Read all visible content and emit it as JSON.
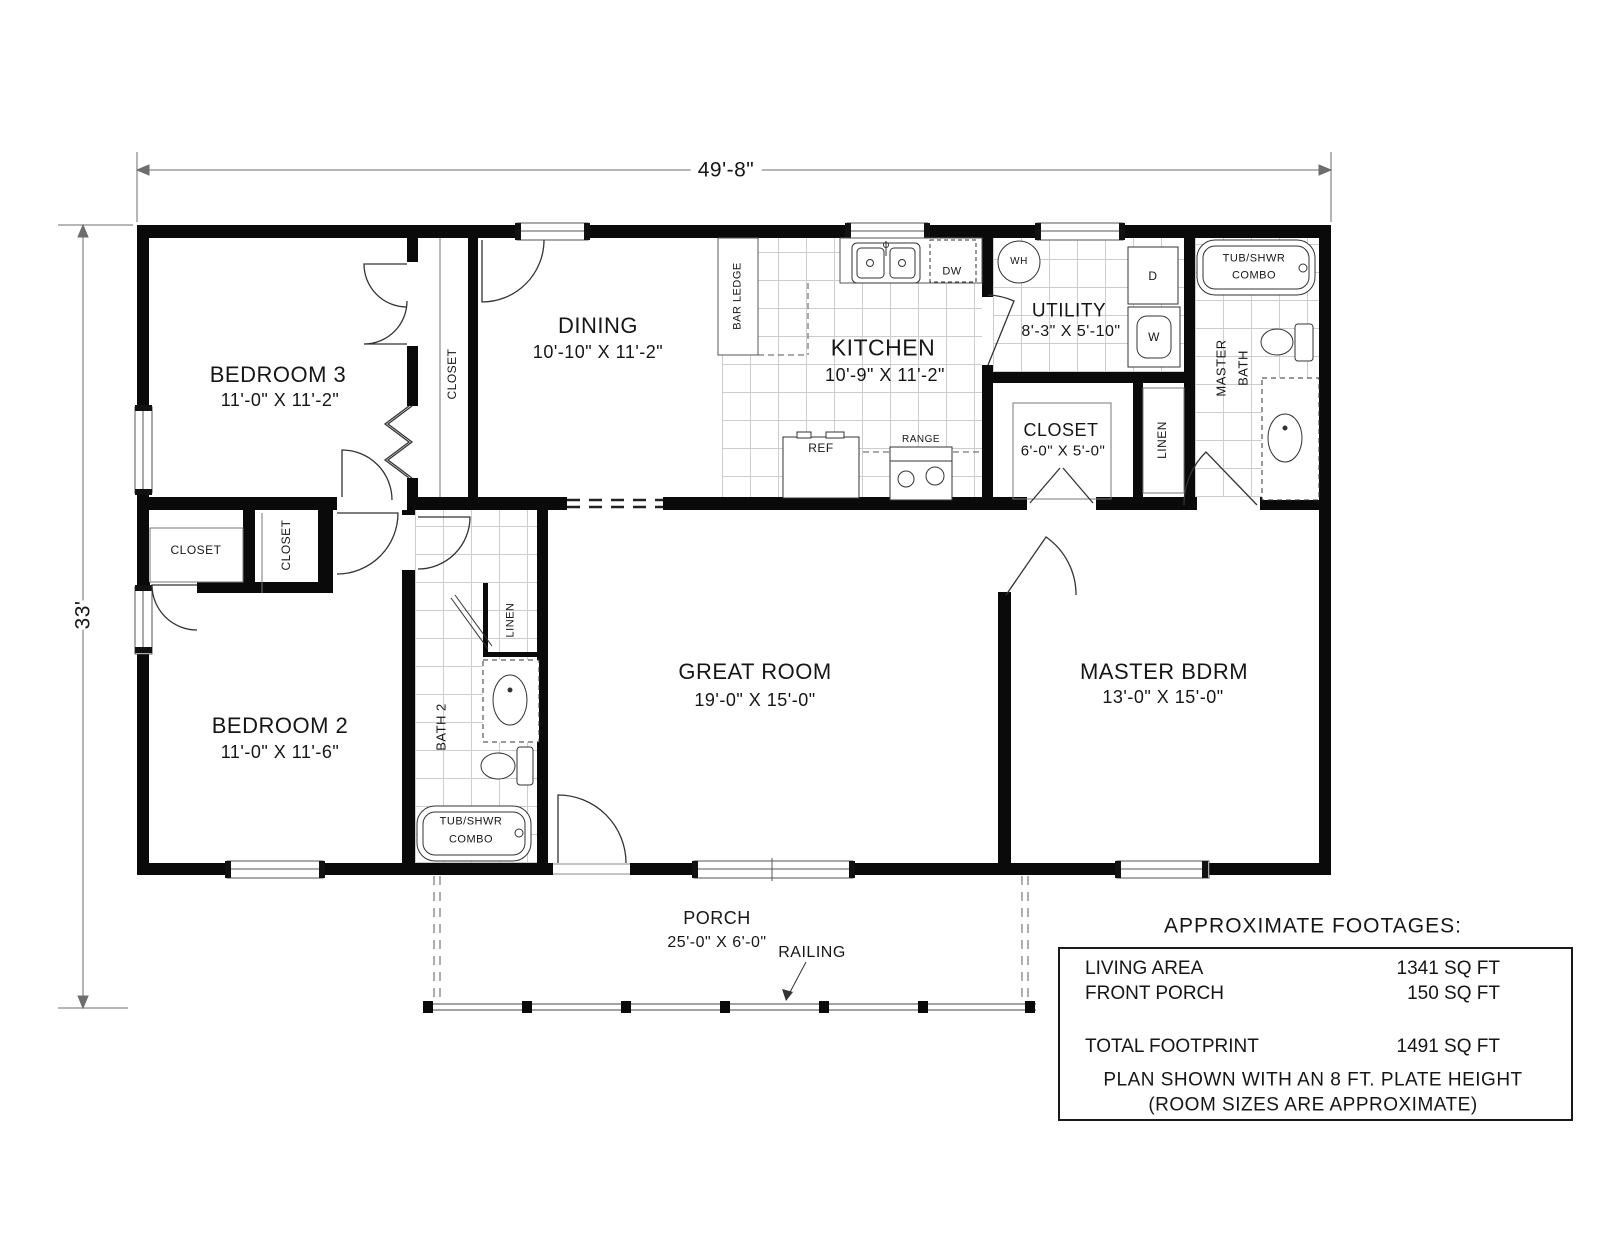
{
  "dimensions": {
    "overall_width": "49'-8\"",
    "overall_depth": "33'"
  },
  "rooms": {
    "bedroom3": {
      "name": "BEDROOM 3",
      "size": "11'-0\" X 11'-2\""
    },
    "dining": {
      "name": "DINING",
      "size": "10'-10\" X 11'-2\""
    },
    "kitchen": {
      "name": "KITCHEN",
      "size": "10'-9\" X 11'-2\""
    },
    "utility": {
      "name": "UTILITY",
      "size": "8'-3\" X 5'-10\""
    },
    "closet_utility": {
      "name": "CLOSET",
      "size": "6'-0\" X 5'-0\""
    },
    "bedroom2": {
      "name": "BEDROOM 2",
      "size": "11'-0\" X 11'-6\""
    },
    "great_room": {
      "name": "GREAT ROOM",
      "size": "19'-0\" X 15'-0\""
    },
    "master_bedroom": {
      "name": "MASTER BDRM",
      "size": "13'-0\" X 15'-0\""
    },
    "porch": {
      "name": "PORCH",
      "size": "25'-0\" X 6'-0\""
    }
  },
  "labels": {
    "bar_ledge": "BAR LEDGE",
    "closet": "CLOSET",
    "linen": "LINEN",
    "bath2": "BATH 2",
    "master_bath_line1": "MASTER",
    "master_bath_line2": "BATH",
    "tub_shwr_line1": "TUB/SHWR",
    "tub_shwr_line2": "COMBO",
    "railing": "RAILING",
    "water_heater": "WH",
    "dryer": "D",
    "washer": "W",
    "dishwasher": "DW",
    "refrigerator": "REF",
    "range": "RANGE"
  },
  "footages": {
    "title": "APPROXIMATE FOOTAGES:",
    "rows": [
      {
        "label": "LIVING AREA",
        "value": "1341 SQ FT"
      },
      {
        "label": "FRONT PORCH",
        "value": "150 SQ FT"
      },
      {
        "label": "TOTAL FOOTPRINT",
        "value": "1491 SQ FT"
      }
    ],
    "notes": [
      "PLAN SHOWN WITH AN 8 FT. PLATE HEIGHT",
      "(ROOM SIZES ARE APPROXIMATE)"
    ]
  }
}
